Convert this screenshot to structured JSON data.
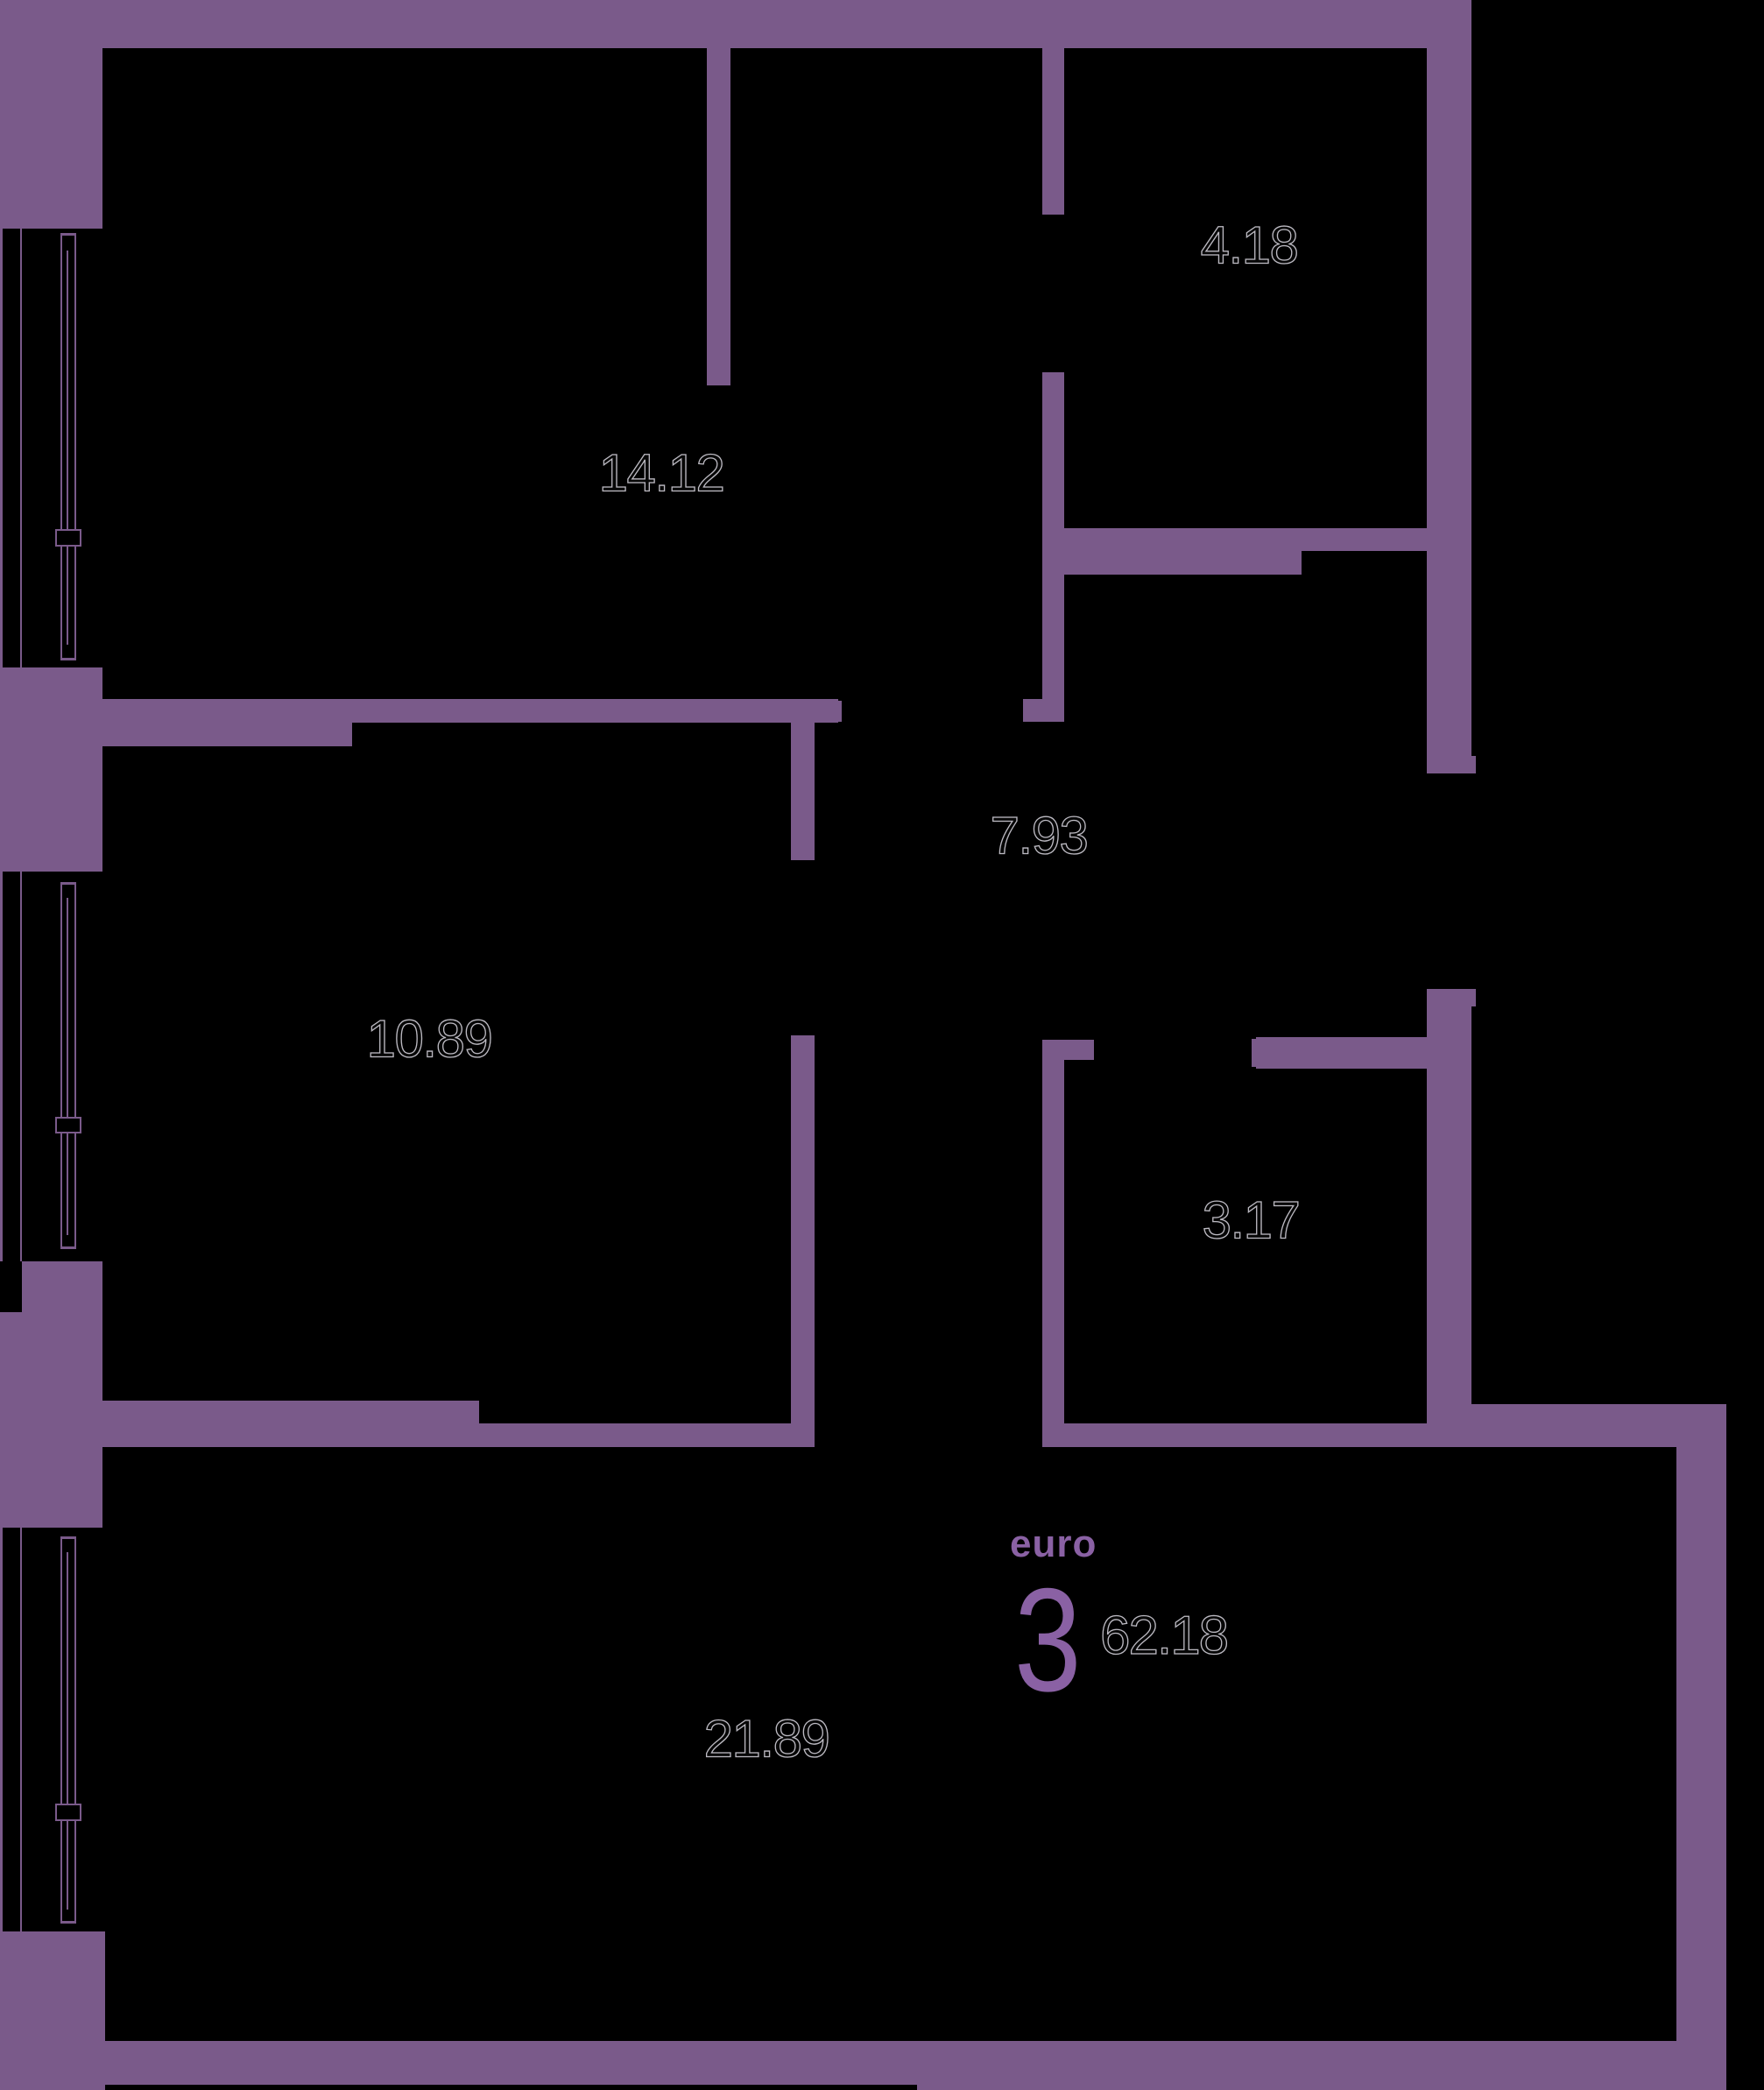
{
  "colors": {
    "background": "#000000",
    "wall": "#7a5a8a",
    "accent": "#8a61a4",
    "label_ink": "#060606",
    "label_outline": "rgba(235,232,242,0.8)"
  },
  "unit": {
    "type_label": "euro",
    "rooms_count": "3",
    "total_area": "62.18"
  },
  "rooms": [
    {
      "id": "bedroom-top",
      "area": "14.12"
    },
    {
      "id": "storeroom",
      "area": "4.18"
    },
    {
      "id": "hallway",
      "area": "7.93"
    },
    {
      "id": "bedroom-middle",
      "area": "10.89"
    },
    {
      "id": "bathroom",
      "area": "3.17"
    },
    {
      "id": "living-kitchen",
      "area": "21.89"
    }
  ]
}
